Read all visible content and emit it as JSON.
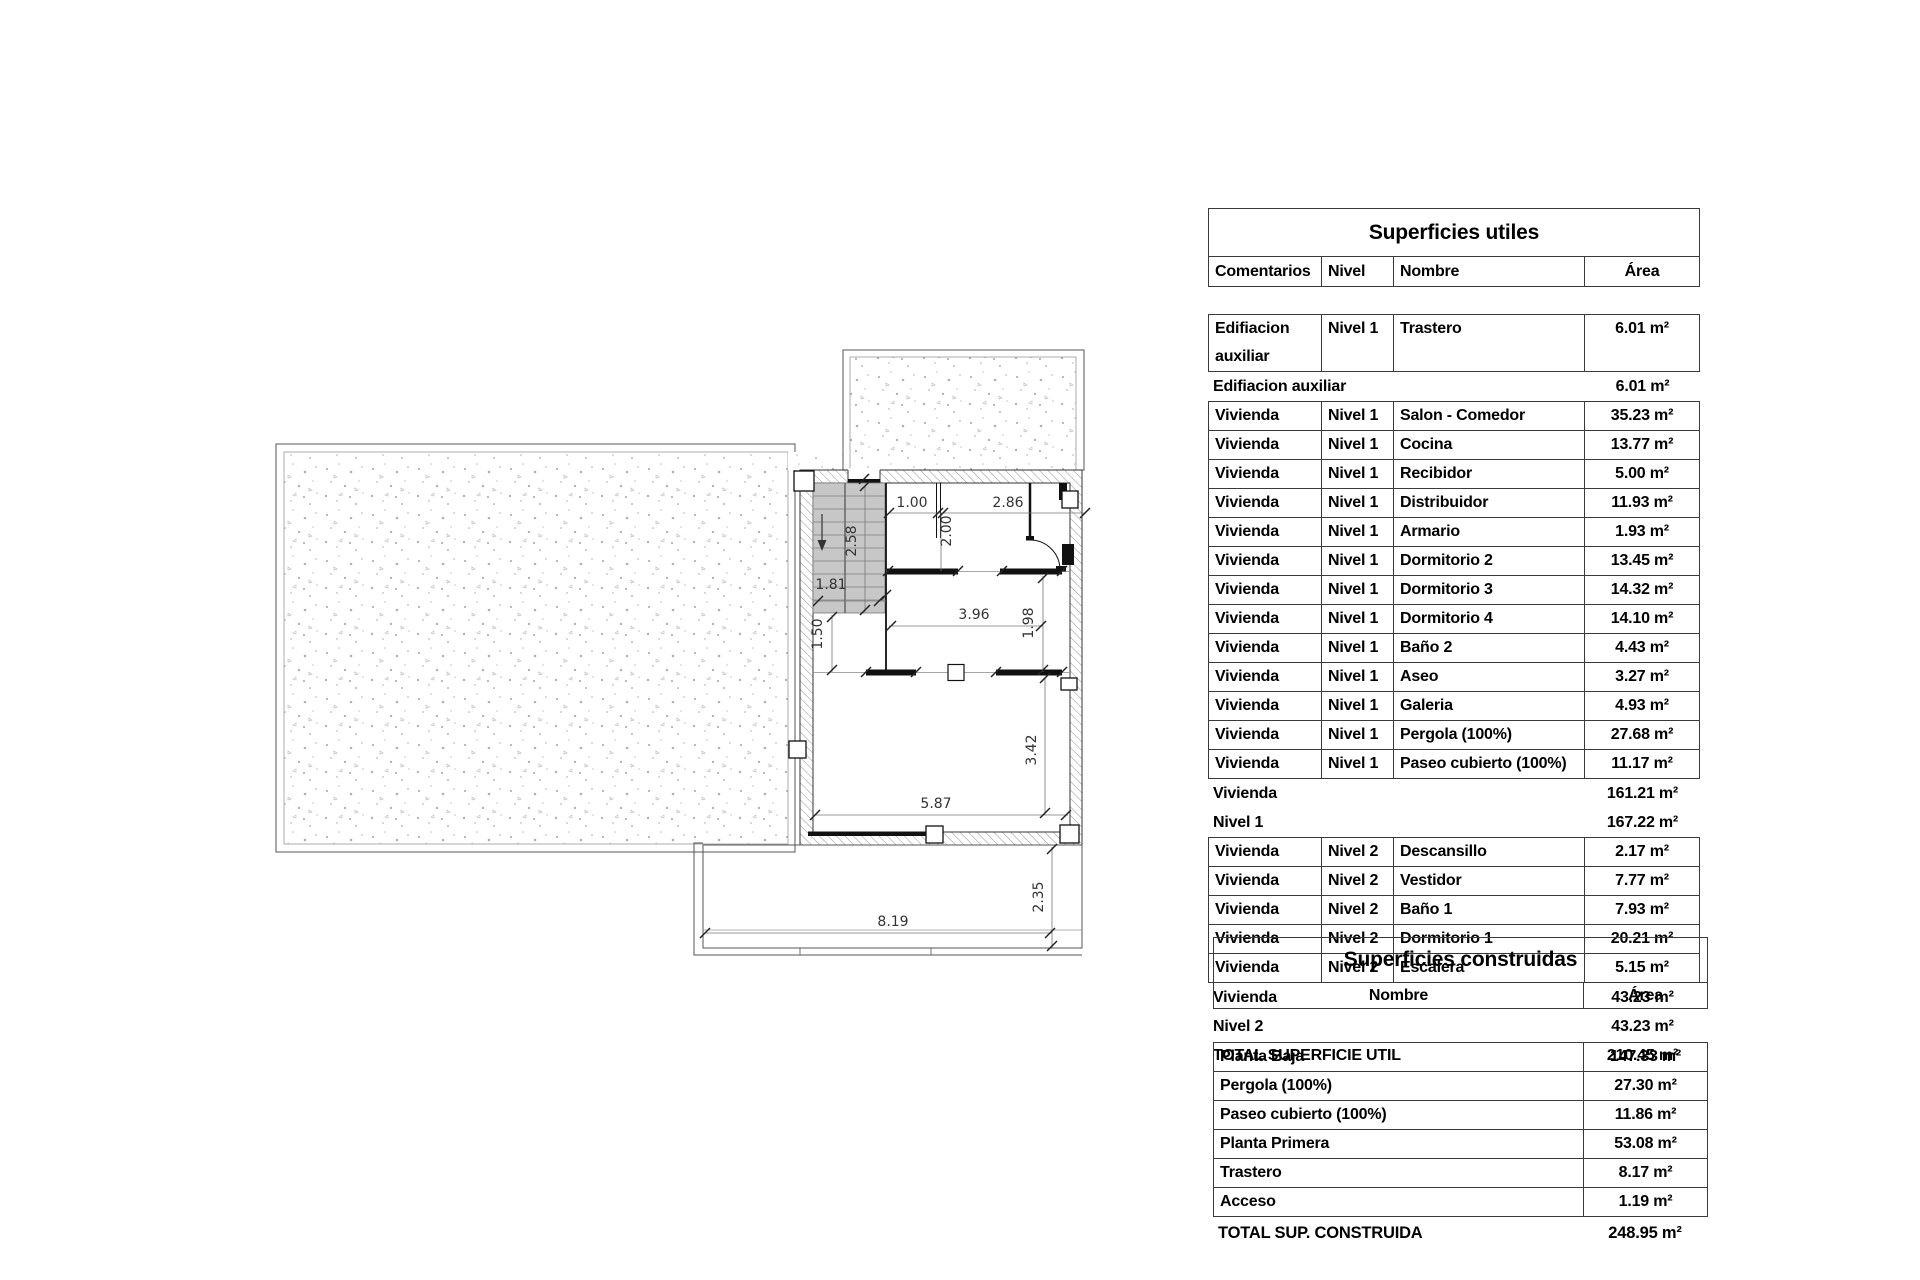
{
  "palette": {
    "ink": "#111111",
    "drawing_line": "#555555",
    "wall_hatch": "#9a9a9a",
    "stair_fill": "#c7c7c7",
    "stipple_dot": "#b3b3b3",
    "table_border": "#3a3a3a"
  },
  "plan": {
    "dimensions": [
      "1.00",
      "2.86",
      "2.00",
      "2.58",
      "1.81",
      "1.50",
      "3.96",
      "1.98",
      "3.42",
      "5.87",
      "2.35",
      "8.19"
    ]
  },
  "superficies_utiles": {
    "title": "Superficies utiles",
    "columns": [
      "Comentarios",
      "Nivel",
      "Nombre",
      "Área"
    ],
    "rows": [
      {
        "type": "data",
        "comentarios": "Edifiacion auxiliar",
        "nivel": "Nivel 1",
        "nombre": "Trastero",
        "area": "6.01 m²"
      },
      {
        "type": "subtotal",
        "label": "Edifiacion auxiliar",
        "area": "6.01 m²"
      },
      {
        "type": "data",
        "comentarios": "Vivienda",
        "nivel": "Nivel 1",
        "nombre": "Salon - Comedor",
        "area": "35.23 m²"
      },
      {
        "type": "data",
        "comentarios": "Vivienda",
        "nivel": "Nivel 1",
        "nombre": "Cocina",
        "area": "13.77 m²"
      },
      {
        "type": "data",
        "comentarios": "Vivienda",
        "nivel": "Nivel 1",
        "nombre": "Recibidor",
        "area": "5.00 m²"
      },
      {
        "type": "data",
        "comentarios": "Vivienda",
        "nivel": "Nivel 1",
        "nombre": "Distribuidor",
        "area": "11.93 m²"
      },
      {
        "type": "data",
        "comentarios": "Vivienda",
        "nivel": "Nivel 1",
        "nombre": "Armario",
        "area": "1.93 m²"
      },
      {
        "type": "data",
        "comentarios": "Vivienda",
        "nivel": "Nivel 1",
        "nombre": "Dormitorio 2",
        "area": "13.45 m²"
      },
      {
        "type": "data",
        "comentarios": "Vivienda",
        "nivel": "Nivel 1",
        "nombre": "Dormitorio 3",
        "area": "14.32 m²"
      },
      {
        "type": "data",
        "comentarios": "Vivienda",
        "nivel": "Nivel 1",
        "nombre": "Dormitorio 4",
        "area": "14.10 m²"
      },
      {
        "type": "data",
        "comentarios": "Vivienda",
        "nivel": "Nivel 1",
        "nombre": "Baño 2",
        "area": "4.43 m²"
      },
      {
        "type": "data",
        "comentarios": "Vivienda",
        "nivel": "Nivel 1",
        "nombre": "Aseo",
        "area": "3.27 m²"
      },
      {
        "type": "data",
        "comentarios": "Vivienda",
        "nivel": "Nivel 1",
        "nombre": "Galeria",
        "area": "4.93 m²"
      },
      {
        "type": "data",
        "comentarios": "Vivienda",
        "nivel": "Nivel 1",
        "nombre": "Pergola (100%)",
        "area": "27.68 m²"
      },
      {
        "type": "data",
        "comentarios": "Vivienda",
        "nivel": "Nivel 1",
        "nombre": "Paseo cubierto (100%)",
        "area": "11.17 m²"
      },
      {
        "type": "subtotal",
        "label": "Vivienda",
        "area": "161.21 m²"
      },
      {
        "type": "subtotal",
        "label": "Nivel 1",
        "area": "167.22 m²"
      },
      {
        "type": "data",
        "comentarios": "Vivienda",
        "nivel": "Nivel 2",
        "nombre": "Descansillo",
        "area": "2.17 m²"
      },
      {
        "type": "data",
        "comentarios": "Vivienda",
        "nivel": "Nivel 2",
        "nombre": "Vestidor",
        "area": "7.77 m²"
      },
      {
        "type": "data",
        "comentarios": "Vivienda",
        "nivel": "Nivel 2",
        "nombre": "Baño 1",
        "area": "7.93 m²"
      },
      {
        "type": "data",
        "comentarios": "Vivienda",
        "nivel": "Nivel 2",
        "nombre": "Dormitorio 1",
        "area": "20.21 m²"
      },
      {
        "type": "data",
        "comentarios": "Vivienda",
        "nivel": "Nivel 2",
        "nombre": "Escalera",
        "area": "5.15 m²"
      },
      {
        "type": "subtotal",
        "label": "Vivienda",
        "area": "43.23 m²"
      },
      {
        "type": "subtotal",
        "label": "Nivel 2",
        "area": "43.23 m²"
      },
      {
        "type": "total",
        "label": "TOTAL SUPERFICIE UTIL",
        "area": "210.45 m²"
      }
    ]
  },
  "superficies_construidas": {
    "title": "Superficies construidas",
    "columns": [
      "Nombre",
      "Área"
    ],
    "rows": [
      {
        "type": "data",
        "nombre": "Planta Baja",
        "area": "147.33 m²"
      },
      {
        "type": "data",
        "nombre": "Pergola (100%)",
        "area": "27.30 m²"
      },
      {
        "type": "data",
        "nombre": "Paseo cubierto (100%)",
        "area": "11.86 m²"
      },
      {
        "type": "data",
        "nombre": "Planta Primera",
        "area": "53.08 m²"
      },
      {
        "type": "data",
        "nombre": "Trastero",
        "area": "8.17 m²"
      },
      {
        "type": "data",
        "nombre": "Acceso",
        "area": "1.19 m²"
      },
      {
        "type": "total",
        "label": "TOTAL SUP. CONSTRUIDA",
        "area": "248.95 m²"
      }
    ]
  }
}
